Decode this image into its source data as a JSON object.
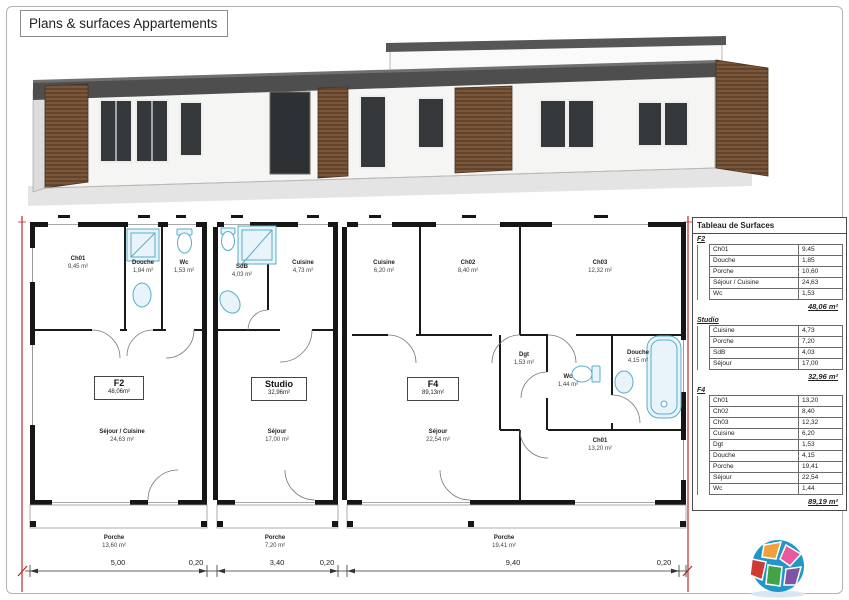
{
  "title": "Plans & surfaces Appartements",
  "plan": {
    "f2": {
      "name": "F2",
      "area": "48,06m²",
      "rooms": {
        "ch01": {
          "name": "Ch01",
          "area": "9,45 m²"
        },
        "douche": {
          "name": "Douche",
          "area": "1,84 m²"
        },
        "wc": {
          "name": "Wc",
          "area": "1,53 m²"
        },
        "sejour": {
          "name": "Séjour / Cuisine",
          "area": "24,63 m²"
        },
        "porche": {
          "name": "Porche",
          "area": "13,60 m²"
        }
      }
    },
    "studio": {
      "name": "Studio",
      "area": "32,96m²",
      "rooms": {
        "sdb": {
          "name": "SdB",
          "area": "4,03 m²"
        },
        "cuisine": {
          "name": "Cuisine",
          "area": "4,73 m²"
        },
        "sejour": {
          "name": "Séjour",
          "area": "17,00 m²"
        },
        "porche": {
          "name": "Porche",
          "area": "7,20 m²"
        }
      }
    },
    "f4": {
      "name": "F4",
      "area": "89,13m²",
      "rooms": {
        "cuisine": {
          "name": "Cuisine",
          "area": "6,20 m²"
        },
        "ch02": {
          "name": "Ch02",
          "area": "8,40 m²"
        },
        "ch03": {
          "name": "Ch03",
          "area": "12,32 m²"
        },
        "dgt": {
          "name": "Dgt",
          "area": "1,53 m²"
        },
        "wc": {
          "name": "Wc",
          "area": "1,44 m²"
        },
        "douche": {
          "name": "Douche",
          "area": "4,15 m²"
        },
        "ch01": {
          "name": "Ch01",
          "area": "13,20 m²"
        },
        "sejour": {
          "name": "Séjour",
          "area": "22,54 m²"
        },
        "porche": {
          "name": "Porche",
          "area": "19,41 m²"
        }
      }
    }
  },
  "dimensions": {
    "d1": "5,00",
    "d2": "0,20",
    "d3": "3,40",
    "d4": "0,20",
    "d5": "9,40",
    "d6": "0,20"
  },
  "surface_table": {
    "title": "Tableau de Surfaces",
    "sections": [
      {
        "name": "F2",
        "rows": [
          {
            "label": "Ch01",
            "value": "9,45"
          },
          {
            "label": "Douche",
            "value": "1,85"
          },
          {
            "label": "Porche",
            "value": "10,60"
          },
          {
            "label": "Séjour / Cuisine",
            "value": "24,63"
          },
          {
            "label": "Wc",
            "value": "1,53"
          }
        ],
        "total": "48,06 m²"
      },
      {
        "name": "Studio",
        "rows": [
          {
            "label": "Cuisine",
            "value": "4,73"
          },
          {
            "label": "Porche",
            "value": "7,20"
          },
          {
            "label": "SdB",
            "value": "4,03"
          },
          {
            "label": "Séjour",
            "value": "17,00"
          }
        ],
        "total": "32,96 m²"
      },
      {
        "name": "F4",
        "rows": [
          {
            "label": "Ch01",
            "value": "13,20"
          },
          {
            "label": "Ch02",
            "value": "8,40"
          },
          {
            "label": "Ch03",
            "value": "12,32"
          },
          {
            "label": "Cuisine",
            "value": "6,20"
          },
          {
            "label": "Dgt",
            "value": "1,53"
          },
          {
            "label": "Douche",
            "value": "4,15"
          },
          {
            "label": "Porche",
            "value": "19,41"
          },
          {
            "label": "Séjour",
            "value": "22,54"
          },
          {
            "label": "Wc",
            "value": "1,44"
          }
        ],
        "total": "89,19 m²"
      }
    ]
  }
}
